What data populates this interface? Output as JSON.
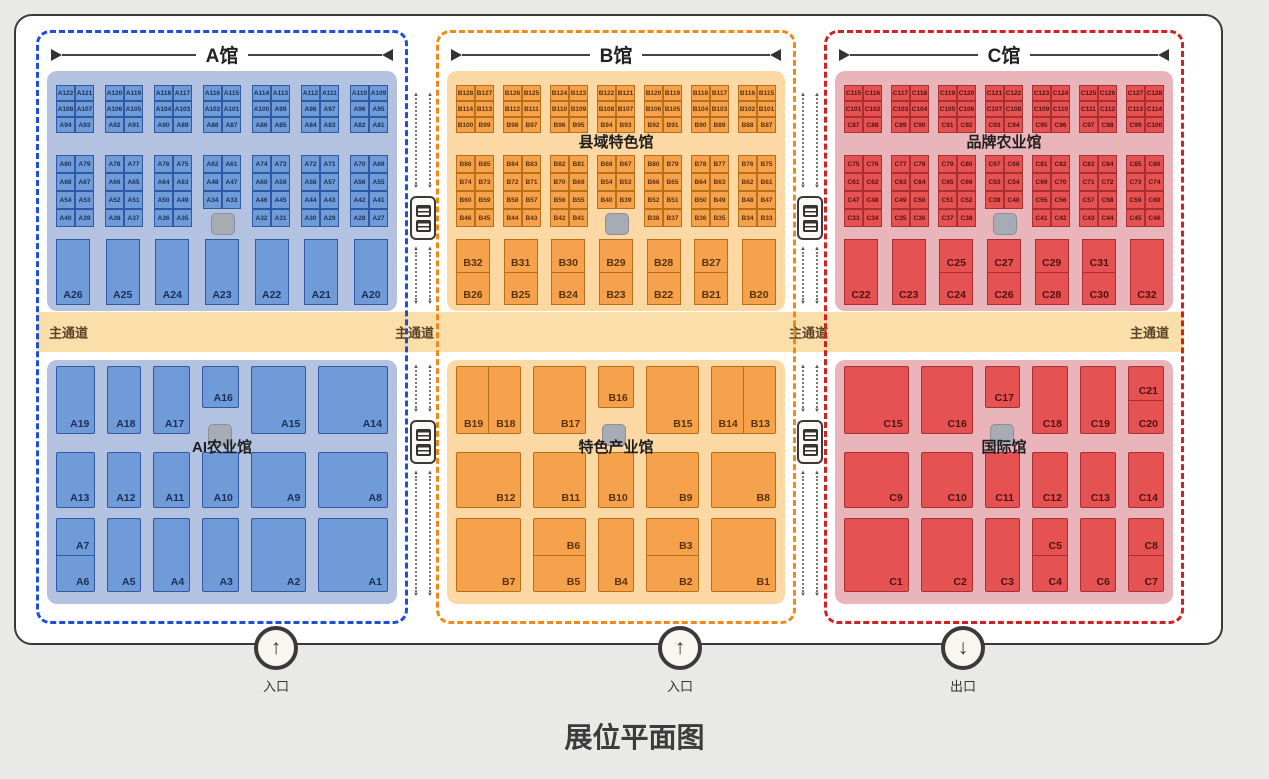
{
  "title": "展位平面图",
  "aisle_labels": [
    "主通道",
    "主通道",
    "主通道",
    "主通道"
  ],
  "icons": {
    "entrance_arrow_up": "↑",
    "exit_arrow_down": "↓",
    "flow_arrow_up": "▲",
    "flow_arrow_down": "▼",
    "dimension_left_marker": "▶",
    "dimension_right_marker": "◀",
    "escalator_icon": "escalator",
    "pillar_marker_icon": "gray-square"
  },
  "colors": {
    "page_bg": "#e9e9e7",
    "frame_bg": "#ffffff",
    "frame_border": "#3a3a3a",
    "aisle_band": "#fbdfab",
    "aisle_text": "#5a4428",
    "gray_marker": "#a7abb4",
    "gray_marker_border": "#8a8f99"
  },
  "entrances": [
    {
      "label": "入口",
      "icon": "arrow-up"
    },
    {
      "label": "入口",
      "icon": "arrow-up"
    },
    {
      "label": "出口",
      "icon": "arrow-down"
    }
  ],
  "halls": [
    {
      "name": "A馆",
      "top_label": "",
      "bottom_label": "AI农业馆",
      "colors": {
        "dash": "#1f4fd8",
        "panel": "#b4c2e2",
        "booth": "#6f9bd8",
        "booth_border": "#2d59a5",
        "text": "#1c2e55"
      },
      "top_blocks_1": [
        [
          [
            "A122",
            "A121"
          ],
          [
            "A108",
            "A107"
          ],
          [
            "A94",
            "A93"
          ]
        ],
        [
          [
            "A120",
            "A119"
          ],
          [
            "A106",
            "A105"
          ],
          [
            "A92",
            "A91"
          ]
        ],
        [
          [
            "A118",
            "A117"
          ],
          [
            "A104",
            "A103"
          ],
          [
            "A90",
            "A89"
          ]
        ],
        [
          [
            "A116",
            "A115"
          ],
          [
            "A102",
            "A101"
          ],
          [
            "A88",
            "A87"
          ]
        ],
        [
          [
            "A114",
            "A113"
          ],
          [
            "A100",
            "A99"
          ],
          [
            "A86",
            "A85"
          ]
        ],
        [
          [
            "A112",
            "A111"
          ],
          [
            "A98",
            "A97"
          ],
          [
            "A84",
            "A83"
          ]
        ],
        [
          [
            "A110",
            "A109"
          ],
          [
            "A96",
            "A95"
          ],
          [
            "A82",
            "A81"
          ]
        ]
      ],
      "top_blocks_2": [
        [
          [
            "A80",
            "A79"
          ],
          [
            "A68",
            "A67"
          ],
          [
            "A54",
            "A53"
          ],
          [
            "A40",
            "A39"
          ]
        ],
        [
          [
            "A78",
            "A77"
          ],
          [
            "A66",
            "A65"
          ],
          [
            "A52",
            "A51"
          ],
          [
            "A38",
            "A37"
          ]
        ],
        [
          [
            "A76",
            "A75"
          ],
          [
            "A64",
            "A63"
          ],
          [
            "A50",
            "A49"
          ],
          [
            "A36",
            "A35"
          ]
        ],
        [
          [
            "A62",
            "A61"
          ],
          [
            "A48",
            "A47"
          ],
          [
            "A34",
            "A33"
          ]
        ],
        [
          [
            "A74",
            "A73"
          ],
          [
            "A60",
            "A59"
          ],
          [
            "A46",
            "A45"
          ],
          [
            "A32",
            "A31"
          ]
        ],
        [
          [
            "A72",
            "A71"
          ],
          [
            "A58",
            "A57"
          ],
          [
            "A44",
            "A43"
          ],
          [
            "A30",
            "A29"
          ]
        ],
        [
          [
            "A70",
            "A69"
          ],
          [
            "A56",
            "A55"
          ],
          [
            "A42",
            "A41"
          ],
          [
            "A28",
            "A27"
          ]
        ]
      ],
      "mid": [
        {
          "l": "A26"
        },
        {
          "l": "A25"
        },
        {
          "l": "A24"
        },
        {
          "l": "A23"
        },
        {
          "l": "A22"
        },
        {
          "l": "A21"
        },
        {
          "l": "A20"
        }
      ],
      "bottom": {
        "cols": [
          42,
          36,
          39,
          39,
          60,
          76
        ],
        "rows": [
          [
            {
              "l": "A19"
            },
            {
              "l": "A18"
            },
            {
              "l": "A17"
            },
            {
              "l": "A16",
              "short": true
            },
            {
              "l": "A15"
            },
            {
              "l": "A14"
            }
          ],
          [
            {
              "l": "A13"
            },
            {
              "l": "A12"
            },
            {
              "l": "A11"
            },
            {
              "l": "A10"
            },
            {
              "l": "A9"
            },
            {
              "l": "A8"
            }
          ],
          [
            {
              "hs": [
                "A7",
                "A6"
              ]
            },
            {
              "l": "A5"
            },
            {
              "l": "A4"
            },
            {
              "l": "A3"
            },
            {
              "l": "A2"
            },
            {
              "l": "A1"
            }
          ]
        ]
      }
    },
    {
      "name": "B馆",
      "top_label": "县域特色馆",
      "bottom_label": "特色产业馆",
      "colors": {
        "dash": "#f08a16",
        "panel": "#fcd8a5",
        "booth": "#f6a24c",
        "booth_border": "#b96f15",
        "text": "#5a3305"
      },
      "top_blocks_1": [
        [
          [
            "B128",
            "B127"
          ],
          [
            "B114",
            "B113"
          ],
          [
            "B100",
            "B99"
          ]
        ],
        [
          [
            "B126",
            "B125"
          ],
          [
            "B112",
            "B111"
          ],
          [
            "B98",
            "B97"
          ]
        ],
        [
          [
            "B124",
            "B123"
          ],
          [
            "B110",
            "B109"
          ],
          [
            "B96",
            "B95"
          ]
        ],
        [
          [
            "B122",
            "B121"
          ],
          [
            "B108",
            "B107"
          ],
          [
            "B94",
            "B93"
          ]
        ],
        [
          [
            "B120",
            "B119"
          ],
          [
            "B106",
            "B105"
          ],
          [
            "B92",
            "B91"
          ]
        ],
        [
          [
            "B118",
            "B117"
          ],
          [
            "B104",
            "B103"
          ],
          [
            "B90",
            "B89"
          ]
        ],
        [
          [
            "B116",
            "B115"
          ],
          [
            "B102",
            "B101"
          ],
          [
            "B88",
            "B87"
          ]
        ]
      ],
      "top_blocks_2": [
        [
          [
            "B86",
            "B85"
          ],
          [
            "B74",
            "B73"
          ],
          [
            "B60",
            "B59"
          ],
          [
            "B46",
            "B45"
          ]
        ],
        [
          [
            "B84",
            "B83"
          ],
          [
            "B72",
            "B71"
          ],
          [
            "B58",
            "B57"
          ],
          [
            "B44",
            "B43"
          ]
        ],
        [
          [
            "B82",
            "B81"
          ],
          [
            "B70",
            "B69"
          ],
          [
            "B56",
            "B55"
          ],
          [
            "B42",
            "B41"
          ]
        ],
        [
          [
            "B68",
            "B67"
          ],
          [
            "B54",
            "B53"
          ],
          [
            "B40",
            "B39"
          ]
        ],
        [
          [
            "B80",
            "B79"
          ],
          [
            "B66",
            "B65"
          ],
          [
            "B52",
            "B51"
          ],
          [
            "B38",
            "B37"
          ]
        ],
        [
          [
            "B78",
            "B77"
          ],
          [
            "B64",
            "B63"
          ],
          [
            "B50",
            "B49"
          ],
          [
            "B36",
            "B35"
          ]
        ],
        [
          [
            "B76",
            "B75"
          ],
          [
            "B62",
            "B61"
          ],
          [
            "B48",
            "B47"
          ],
          [
            "B34",
            "B33"
          ]
        ]
      ],
      "mid": [
        {
          "hs": [
            "B32",
            "B26"
          ]
        },
        {
          "hs": [
            "B31",
            "B25"
          ]
        },
        {
          "hs": [
            "B30",
            "B24"
          ]
        },
        {
          "hs": [
            "B29",
            "B23"
          ]
        },
        {
          "hs": [
            "B28",
            "B22"
          ]
        },
        {
          "hs": [
            "B27",
            "B21"
          ]
        },
        {
          "l": "B20"
        }
      ],
      "bottom": {
        "cols": [
          70,
          56,
          37,
          56,
          70
        ],
        "rows": [
          [
            {
              "vs": [
                "B19",
                "B18"
              ]
            },
            {
              "l": "B17"
            },
            {
              "l": "B16",
              "short": true
            },
            {
              "l": "B15"
            },
            {
              "vs": [
                "B14",
                "B13"
              ]
            }
          ],
          [
            {
              "l": "B12"
            },
            {
              "l": "B11"
            },
            {
              "l": "B10"
            },
            {
              "l": "B9"
            },
            {
              "l": "B8"
            }
          ],
          [
            {
              "l": "B7"
            },
            {
              "hs": [
                "B6",
                "B5"
              ]
            },
            {
              "l": "B4"
            },
            {
              "hs": [
                "B3",
                "B2"
              ]
            },
            {
              "l": "B1"
            }
          ]
        ]
      }
    },
    {
      "name": "C馆",
      "top_label": "品牌农业馆",
      "bottom_label": "国际馆",
      "colors": {
        "dash": "#d02222",
        "panel": "#eab5ba",
        "booth": "#e65151",
        "booth_border": "#a93030",
        "text": "#4f1212"
      },
      "top_blocks_1": [
        [
          [
            "C115",
            "C116"
          ],
          [
            "C101",
            "C102"
          ],
          [
            "C87",
            "C88"
          ]
        ],
        [
          [
            "C117",
            "C118"
          ],
          [
            "C103",
            "C104"
          ],
          [
            "C89",
            "C90"
          ]
        ],
        [
          [
            "C119",
            "C120"
          ],
          [
            "C105",
            "C106"
          ],
          [
            "C91",
            "C92"
          ]
        ],
        [
          [
            "C121",
            "C122"
          ],
          [
            "C107",
            "C108"
          ],
          [
            "C93",
            "C94"
          ]
        ],
        [
          [
            "C123",
            "C124"
          ],
          [
            "C109",
            "C110"
          ],
          [
            "C95",
            "C96"
          ]
        ],
        [
          [
            "C125",
            "C126"
          ],
          [
            "C111",
            "C112"
          ],
          [
            "C97",
            "C98"
          ]
        ],
        [
          [
            "C127",
            "C128"
          ],
          [
            "C113",
            "C114"
          ],
          [
            "C99",
            "C100"
          ]
        ]
      ],
      "top_blocks_2": [
        [
          [
            "C75",
            "C76"
          ],
          [
            "C61",
            "C62"
          ],
          [
            "C47",
            "C48"
          ],
          [
            "C33",
            "C34"
          ]
        ],
        [
          [
            "C77",
            "C78"
          ],
          [
            "C63",
            "C64"
          ],
          [
            "C49",
            "C50"
          ],
          [
            "C35",
            "C36"
          ]
        ],
        [
          [
            "C79",
            "C80"
          ],
          [
            "C65",
            "C66"
          ],
          [
            "C51",
            "C52"
          ],
          [
            "C37",
            "C38"
          ]
        ],
        [
          [
            "C67",
            "C68"
          ],
          [
            "C53",
            "C54"
          ],
          [
            "C39",
            "C40"
          ]
        ],
        [
          [
            "C81",
            "C82"
          ],
          [
            "C69",
            "C70"
          ],
          [
            "C55",
            "C56"
          ],
          [
            "C41",
            "C42"
          ]
        ],
        [
          [
            "C83",
            "C84"
          ],
          [
            "C71",
            "C72"
          ],
          [
            "C57",
            "C58"
          ],
          [
            "C43",
            "C44"
          ]
        ],
        [
          [
            "C85",
            "C86"
          ],
          [
            "C73",
            "C74"
          ],
          [
            "C59",
            "C60"
          ],
          [
            "C45",
            "C46"
          ]
        ]
      ],
      "mid": [
        {
          "l": "C22"
        },
        {
          "l": "C23"
        },
        {
          "hs": [
            "C25",
            "C24"
          ]
        },
        {
          "hs": [
            "C27",
            "C26"
          ]
        },
        {
          "hs": [
            "C29",
            "C28"
          ]
        },
        {
          "hs": [
            "C31",
            "C30"
          ]
        },
        {
          "l": "C32"
        }
      ],
      "bottom": {
        "cols": [
          70,
          56,
          37,
          38,
          38,
          38
        ],
        "rows": [
          [
            {
              "l": "C15"
            },
            {
              "l": "C16"
            },
            {
              "l": "C17",
              "short": true
            },
            {
              "l": "C18"
            },
            {
              "l": "C19"
            },
            {
              "hs": [
                "C21",
                "C20"
              ]
            }
          ],
          [
            {
              "l": "C9"
            },
            {
              "l": "C10"
            },
            {
              "l": "C11"
            },
            {
              "l": "C12"
            },
            {
              "l": "C13"
            },
            {
              "l": "C14"
            }
          ],
          [
            {
              "l": "C1"
            },
            {
              "l": "C2"
            },
            {
              "l": "C3"
            },
            {
              "hs": [
                "C5",
                "C4"
              ]
            },
            {
              "l": "C6"
            },
            {
              "hs": [
                "C8",
                "C7"
              ]
            }
          ]
        ]
      }
    }
  ]
}
